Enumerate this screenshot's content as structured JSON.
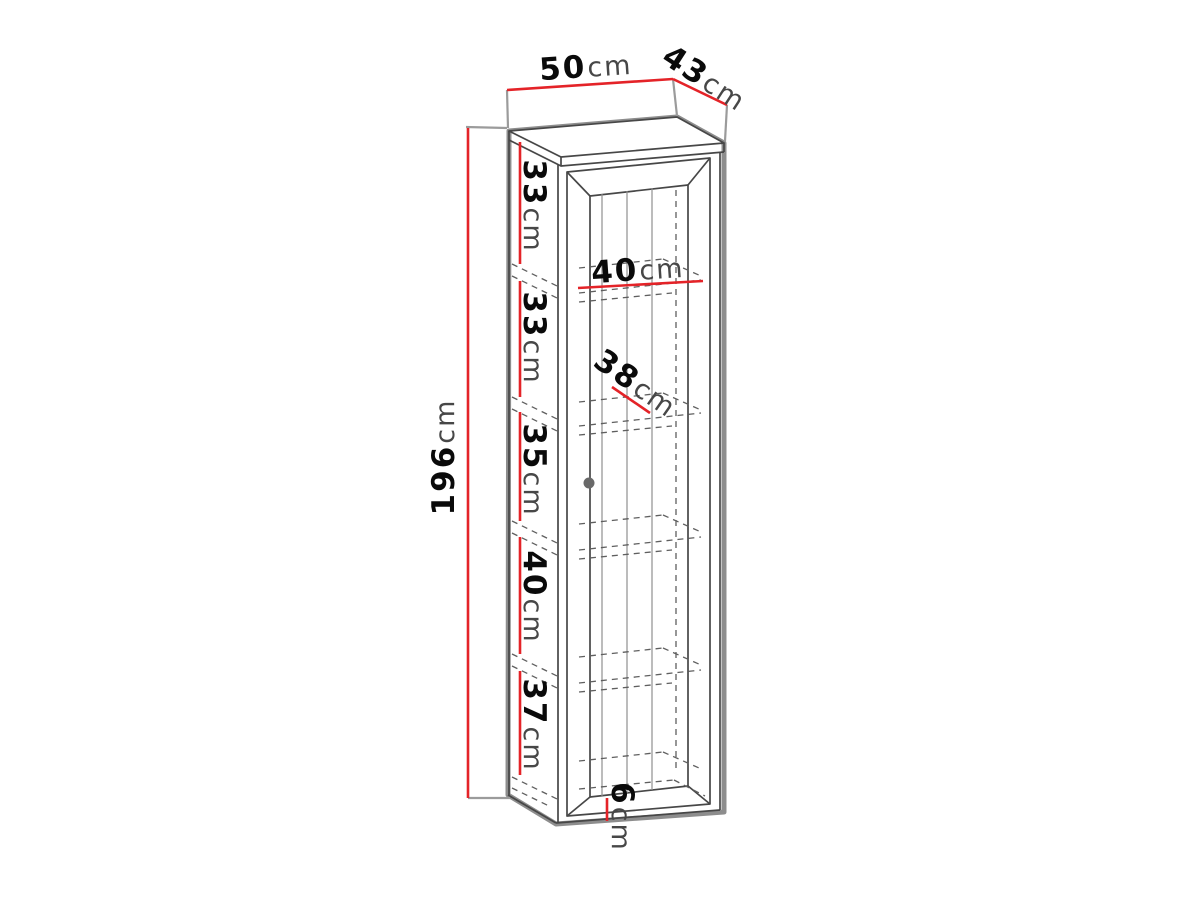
{
  "diagram": {
    "kind": "furniture dimension drawing",
    "subject": "tall one-door display cabinet with interior shelves, drawn in perspective with red dimension lines"
  },
  "colors": {
    "background": "#ffffff",
    "dimension": "#e42328",
    "outline": "#8d8d8d",
    "edge": "#474747",
    "hidden_line": "#5f5f5f",
    "number": "#0a0a0a",
    "unit": "#474747"
  },
  "dimensions": {
    "width": {
      "value": "50",
      "unit": "cm"
    },
    "depth": {
      "value": "43",
      "unit": "cm"
    },
    "height": {
      "value": "196",
      "unit": "cm"
    },
    "interior_width": {
      "value": "40",
      "unit": "cm"
    },
    "interior_depth": {
      "value": "38",
      "unit": "cm"
    },
    "plinth_height": {
      "value": "6",
      "unit": "cm"
    },
    "sections": [
      {
        "value": "33",
        "unit": "cm"
      },
      {
        "value": "33",
        "unit": "cm"
      },
      {
        "value": "35",
        "unit": "cm"
      },
      {
        "value": "40",
        "unit": "cm"
      },
      {
        "value": "37",
        "unit": "cm"
      }
    ]
  }
}
